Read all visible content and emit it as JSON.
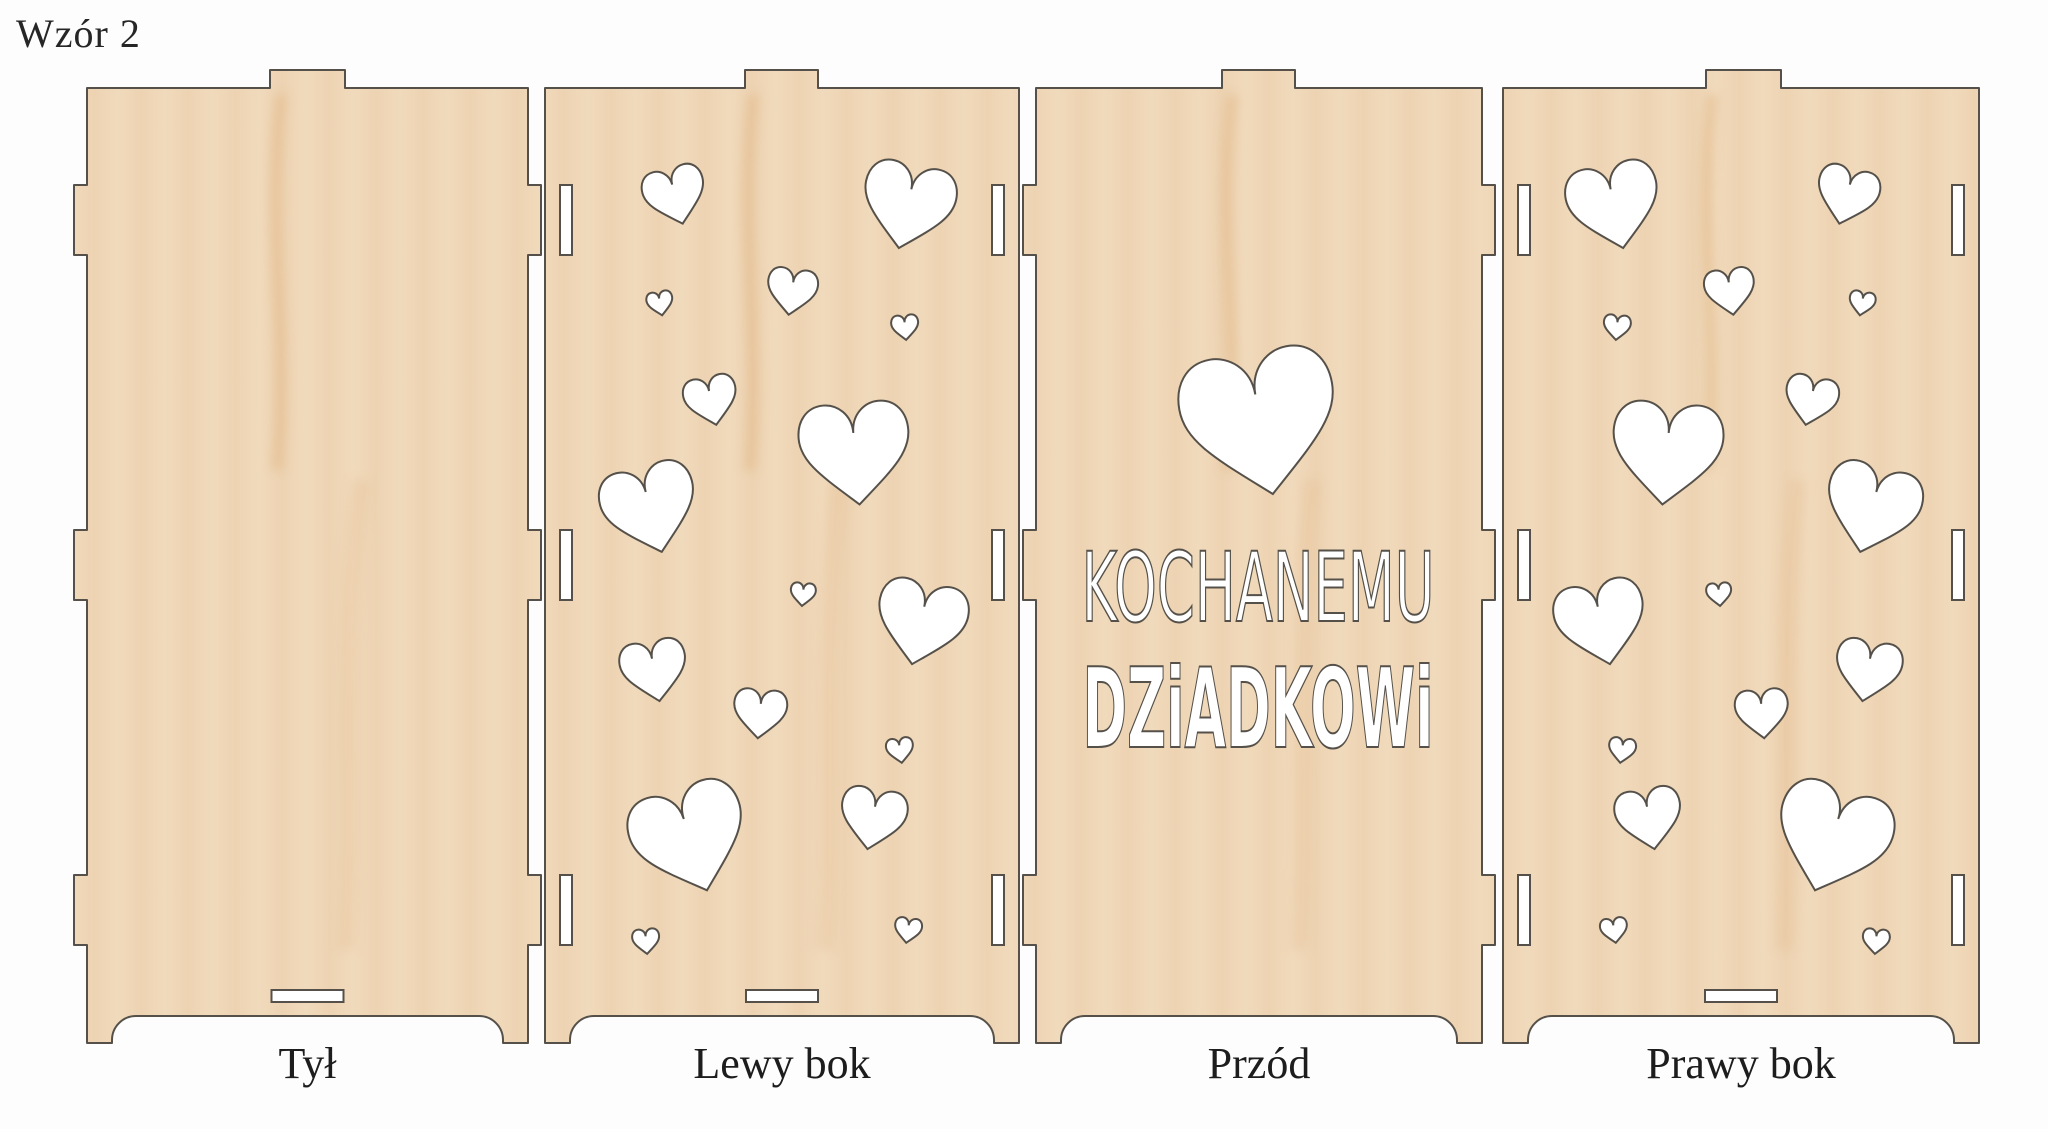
{
  "title": "Wzór 2",
  "colors": {
    "background": "#fdfdfd",
    "wood_base": "#edd3b2",
    "wood_light": "#f4e1c6",
    "wood_streak": "#d9a268",
    "outline": "#55514a",
    "cutout": "#ffffff",
    "text": "#262626"
  },
  "geometry": {
    "sheet_w": 2048,
    "sheet_h": 1129,
    "panel_top": 88,
    "tab_top": 70,
    "side_joint_ys": [
      [
        185,
        255
      ],
      [
        530,
        600
      ],
      [
        875,
        945
      ]
    ],
    "tab_depth": 13,
    "bottom_y": 1016,
    "feet_bottom": 1043,
    "foot_w": 25,
    "arch_r": 24,
    "slot_w": 12,
    "slot_inset": 15,
    "bottom_slot": {
      "w": 72,
      "h": 12,
      "y": 990
    },
    "label_top": 1036
  },
  "panels": [
    {
      "id": "back",
      "label": "Tył",
      "edge": "tabs",
      "x1": 87,
      "x2": 528,
      "top_tab": [
        270,
        345
      ],
      "bottom_slot": true,
      "hearts": []
    },
    {
      "id": "left-side",
      "label": "Lewy bok",
      "edge": "slots",
      "x1": 545,
      "x2": 1019,
      "top_tab": [
        745,
        818
      ],
      "bottom_slot": true,
      "hearts": [
        [
          675,
          195,
          62,
          -15
        ],
        [
          908,
          205,
          92,
          12
        ],
        [
          660,
          303,
          26,
          -10
        ],
        [
          792,
          291,
          50,
          8
        ],
        [
          905,
          327,
          27,
          -5
        ],
        [
          711,
          400,
          53,
          -12
        ],
        [
          855,
          452,
          110,
          -5
        ],
        [
          650,
          508,
          95,
          -15
        ],
        [
          803,
          594,
          25,
          5
        ],
        [
          921,
          622,
          90,
          12
        ],
        [
          654,
          670,
          66,
          -10
        ],
        [
          760,
          713,
          53,
          5
        ],
        [
          900,
          750,
          27,
          -8
        ],
        [
          690,
          838,
          115,
          -18
        ],
        [
          873,
          818,
          66,
          10
        ],
        [
          646,
          941,
          27,
          -5
        ],
        [
          908,
          930,
          27,
          8
        ]
      ]
    },
    {
      "id": "front",
      "label": "Przód",
      "edge": "tabs",
      "x1": 1036,
      "x2": 1482,
      "top_tab": [
        1222,
        1295
      ],
      "bottom_slot": false,
      "hearts": [
        [
          1260,
          421,
          155,
          -10
        ]
      ],
      "text": {
        "lines": [
          "KOCHANEMU",
          "DZiADKOWi"
        ],
        "cx": 1258,
        "baselines": [
          621,
          747
        ],
        "font_sizes": [
          96,
          111
        ],
        "text_lengths": [
          353,
          351
        ],
        "weights": [
          400,
          700
        ]
      }
    },
    {
      "id": "right-side",
      "label": "Prawy bok",
      "edge": "slots",
      "x1": 1503,
      "x2": 1979,
      "top_tab": [
        1706,
        1781
      ],
      "bottom_slot": true,
      "hearts": [
        [
          1847,
          195,
          62,
          15
        ],
        [
          1614,
          205,
          92,
          -12
        ],
        [
          1862,
          303,
          26,
          10
        ],
        [
          1730,
          291,
          50,
          -8
        ],
        [
          1617,
          327,
          27,
          5
        ],
        [
          1811,
          400,
          53,
          12
        ],
        [
          1667,
          452,
          110,
          5
        ],
        [
          1872,
          508,
          95,
          15
        ],
        [
          1719,
          594,
          25,
          -5
        ],
        [
          1601,
          622,
          90,
          -12
        ],
        [
          1868,
          670,
          66,
          10
        ],
        [
          1762,
          713,
          53,
          -5
        ],
        [
          1622,
          750,
          27,
          8
        ],
        [
          1832,
          838,
          115,
          18
        ],
        [
          1649,
          818,
          66,
          -10
        ],
        [
          1876,
          941,
          27,
          5
        ],
        [
          1614,
          930,
          27,
          -8
        ]
      ]
    }
  ]
}
